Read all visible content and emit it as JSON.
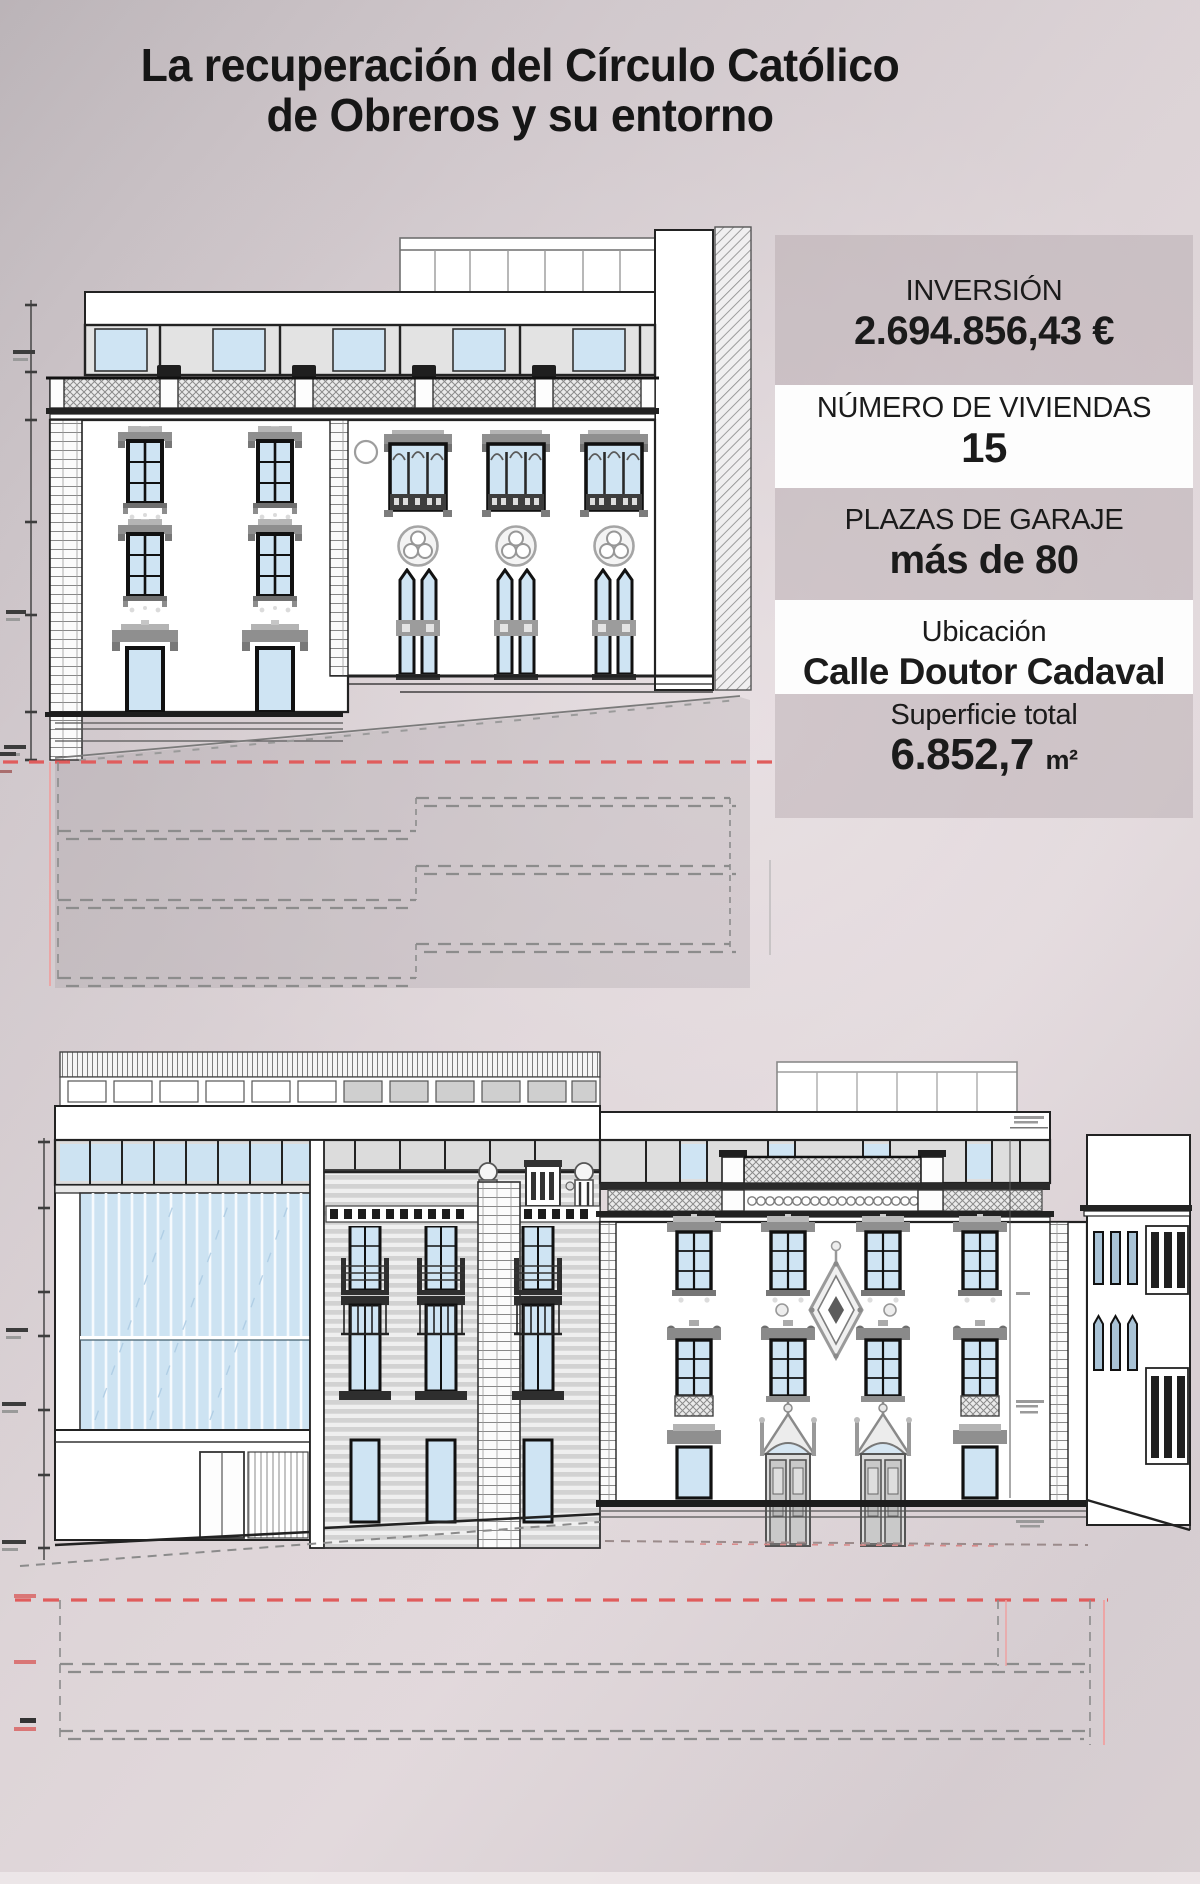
{
  "page": {
    "width": 1200,
    "height": 1884,
    "background_dark": "#b9b2b6",
    "background_light": "#e2d9dc",
    "bottom_strip": "#efe9ea"
  },
  "title": {
    "line1": "La recuperación del Círculo Católico",
    "line2": "de Obreros y su entorno",
    "color": "#161616"
  },
  "info_panel": {
    "band_gray": "rgba(172,158,164,0.38)",
    "band_white": "#fdfdfd",
    "text_color": "#1b1b1b",
    "rows": [
      {
        "label": "INVERSIÓN",
        "value": "2.694.856,43 €"
      },
      {
        "label": "NÚMERO DE VIVIENDAS",
        "value": "15"
      },
      {
        "label": "PLAZAS DE GARAJE",
        "value": "más de 80"
      },
      {
        "label": "Ubicación",
        "value": "Calle Doutor Cadaval"
      },
      {
        "label": "Superficie total",
        "value": "6.852,7",
        "unit": "m²"
      }
    ]
  },
  "drawings": {
    "top_elevation": {
      "line_color": "#1f1f1f",
      "glass_color": "#cfe4f3",
      "detail_gray": "#8f8f8f",
      "level_line_red": "#e05c5c",
      "underground_dash_gray": "#8c8c8c"
    },
    "bottom_elevation": {
      "line_color": "#1f1f1f",
      "glass_color": "#cde3f2",
      "stone_band_gray": "#d2d2d2",
      "level_line_red": "#e05c5c",
      "underground_dash_gray": "#8c8c8c"
    }
  }
}
